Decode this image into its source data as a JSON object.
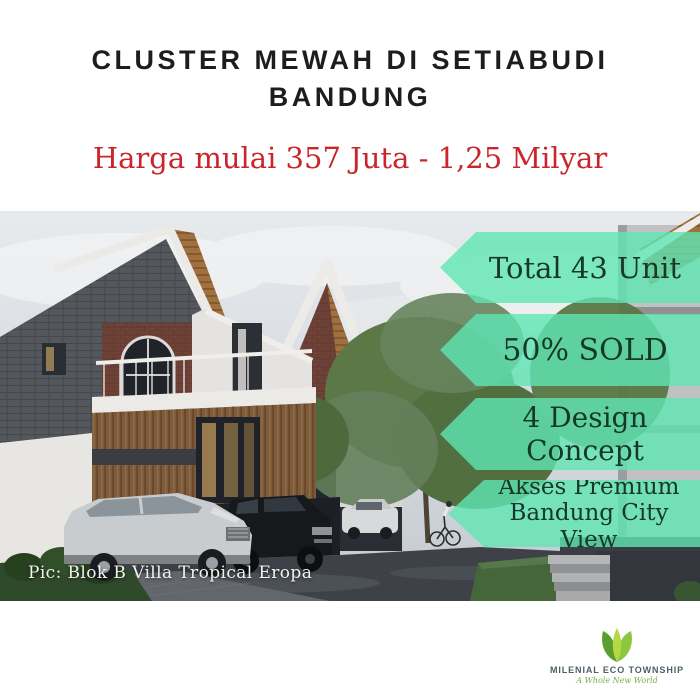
{
  "header": {
    "title_line1": "CLUSTER MEWAH DI SETIABUDI",
    "title_line2": "BANDUNG",
    "price": "Harga mulai 357 Juta - 1,25 Milyar"
  },
  "ribbons": [
    {
      "lines": [
        "Total 43 Unit"
      ]
    },
    {
      "lines": [
        "50% SOLD"
      ]
    },
    {
      "lines": [
        "4 Design Concept"
      ]
    },
    {
      "lines": [
        "Akses Premium",
        "Bandung City View"
      ]
    }
  ],
  "photo": {
    "caption": "Pic: Blok B Villa Tropical Eropa",
    "unit_marker": "B1"
  },
  "footer_logo": {
    "brand": "MILENIAL ECO TOWNSHIP",
    "tagline": "A Whole New World"
  },
  "colors": {
    "ribbon_green": "#5fe6b4",
    "ribbon_text": "#16382a",
    "price_red": "#c9252b",
    "title_black": "#1d1d1d",
    "logo_green": "#76b043"
  }
}
